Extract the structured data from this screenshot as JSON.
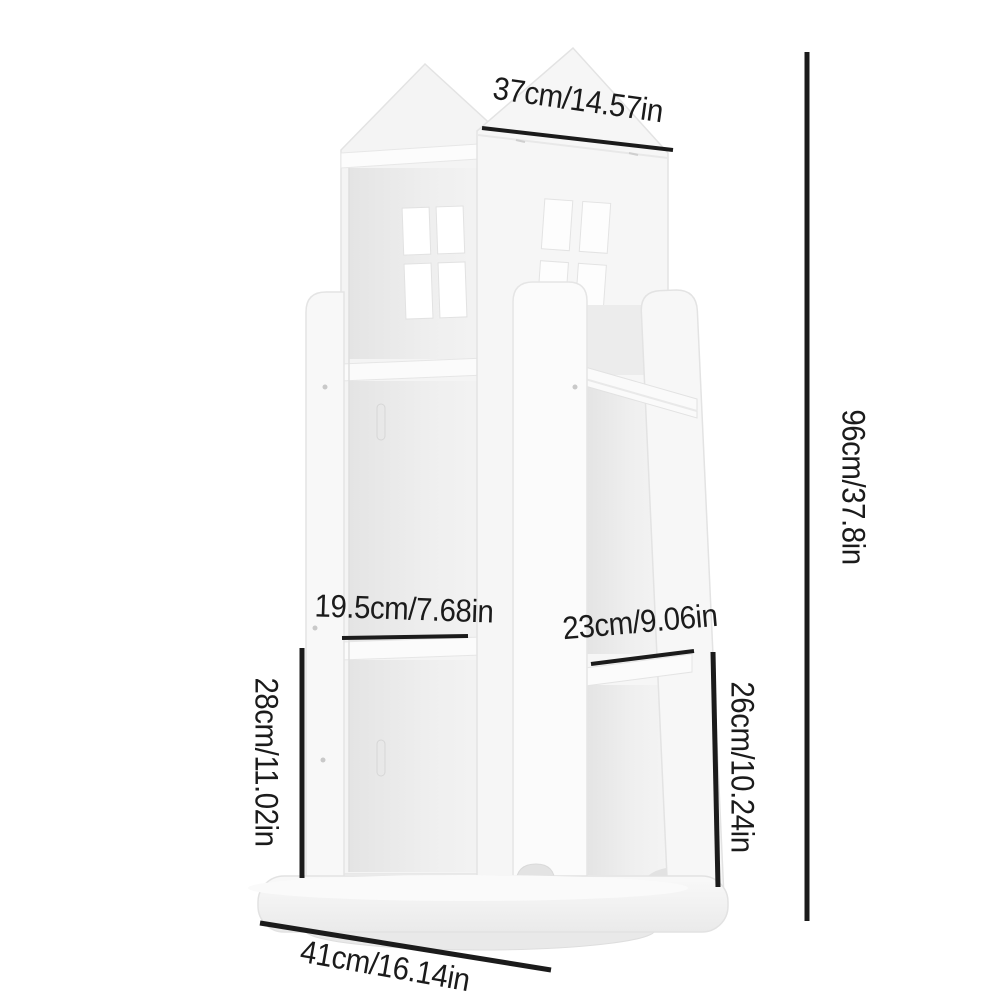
{
  "meta": {
    "background_color": "#ffffff",
    "product_color_hex": "#f6f6f6",
    "annotation_line_color": "#1b1b1b",
    "annotation_text_color": "#1b1b1b"
  },
  "dimensions": {
    "top_width": "37cm/14.57in",
    "overall_height": "96cm/37.8in",
    "left_opening_width": "19.5cm/7.68in",
    "right_opening_width": "23cm/9.06in",
    "left_opening_height": "28cm/11.02in",
    "right_opening_height": "26cm/10.24in",
    "base_width": "41cm/16.14in"
  }
}
